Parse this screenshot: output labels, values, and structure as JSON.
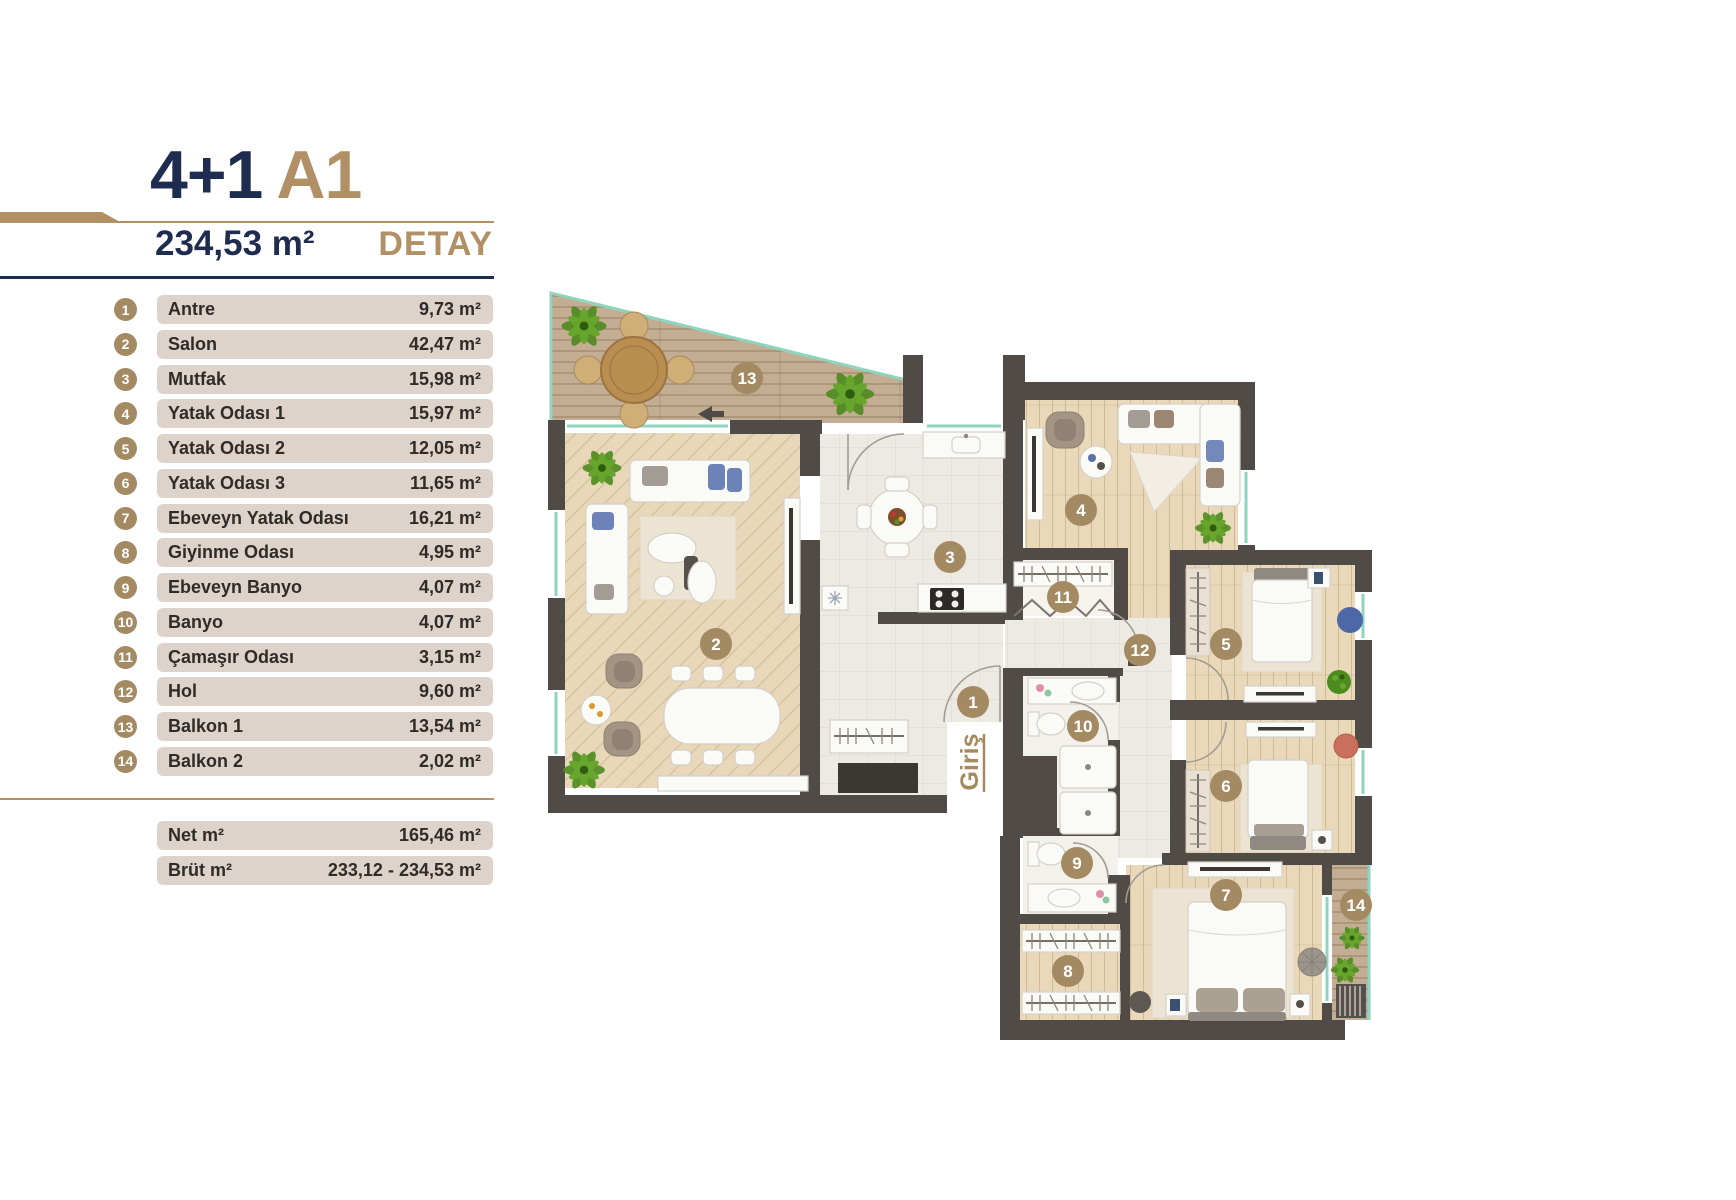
{
  "header": {
    "layout": "4+1",
    "block": "A1",
    "area": "234,53 m²",
    "detail": "DETAY"
  },
  "legend": [
    {
      "num": "1",
      "name": "Antre",
      "area": "9,73 m²"
    },
    {
      "num": "2",
      "name": "Salon",
      "area": "42,47 m²"
    },
    {
      "num": "3",
      "name": "Mutfak",
      "area": "15,98 m²"
    },
    {
      "num": "4",
      "name": "Yatak Odası 1",
      "area": "15,97 m²"
    },
    {
      "num": "5",
      "name": "Yatak Odası 2",
      "area": "12,05 m²"
    },
    {
      "num": "6",
      "name": "Yatak Odası 3",
      "area": "11,65 m²"
    },
    {
      "num": "7",
      "name": "Ebeveyn Yatak Odası",
      "area": "16,21 m²"
    },
    {
      "num": "8",
      "name": "Giyinme Odası",
      "area": "4,95 m²"
    },
    {
      "num": "9",
      "name": "Ebeveyn Banyo",
      "area": "4,07 m²"
    },
    {
      "num": "10",
      "name": "Banyo",
      "area": "4,07 m²"
    },
    {
      "num": "11",
      "name": "Çamaşır Odası",
      "area": "3,15 m²"
    },
    {
      "num": "12",
      "name": "Hol",
      "area": "9,60 m²"
    },
    {
      "num": "13",
      "name": "Balkon 1",
      "area": "13,54 m²"
    },
    {
      "num": "14",
      "name": "Balkon 2",
      "area": "2,02 m²"
    }
  ],
  "totals": [
    {
      "label": "Net m²",
      "value": "165,46 m²"
    },
    {
      "label": "Brüt m²",
      "value": "233,12 - 234,53 m²"
    }
  ],
  "plan": {
    "entrance": "Giriş",
    "badges": [
      {
        "n": "1",
        "x": 973,
        "y": 702
      },
      {
        "n": "2",
        "x": 716,
        "y": 644
      },
      {
        "n": "3",
        "x": 950,
        "y": 557
      },
      {
        "n": "4",
        "x": 1081,
        "y": 510
      },
      {
        "n": "5",
        "x": 1226,
        "y": 644
      },
      {
        "n": "6",
        "x": 1226,
        "y": 786
      },
      {
        "n": "7",
        "x": 1226,
        "y": 895
      },
      {
        "n": "8",
        "x": 1068,
        "y": 971
      },
      {
        "n": "9",
        "x": 1077,
        "y": 863
      },
      {
        "n": "10",
        "x": 1083,
        "y": 726
      },
      {
        "n": "11",
        "x": 1063,
        "y": 597
      },
      {
        "n": "12",
        "x": 1140,
        "y": 650
      },
      {
        "n": "13",
        "x": 747,
        "y": 378
      },
      {
        "n": "14",
        "x": 1356,
        "y": 905
      }
    ]
  },
  "colors": {
    "navy": "#1e2c4f",
    "tan": "#b29066",
    "badge": "#a38a63",
    "row_bg": "#ddd3ca",
    "wall": "#504b46",
    "window": "#8fd4bd"
  }
}
